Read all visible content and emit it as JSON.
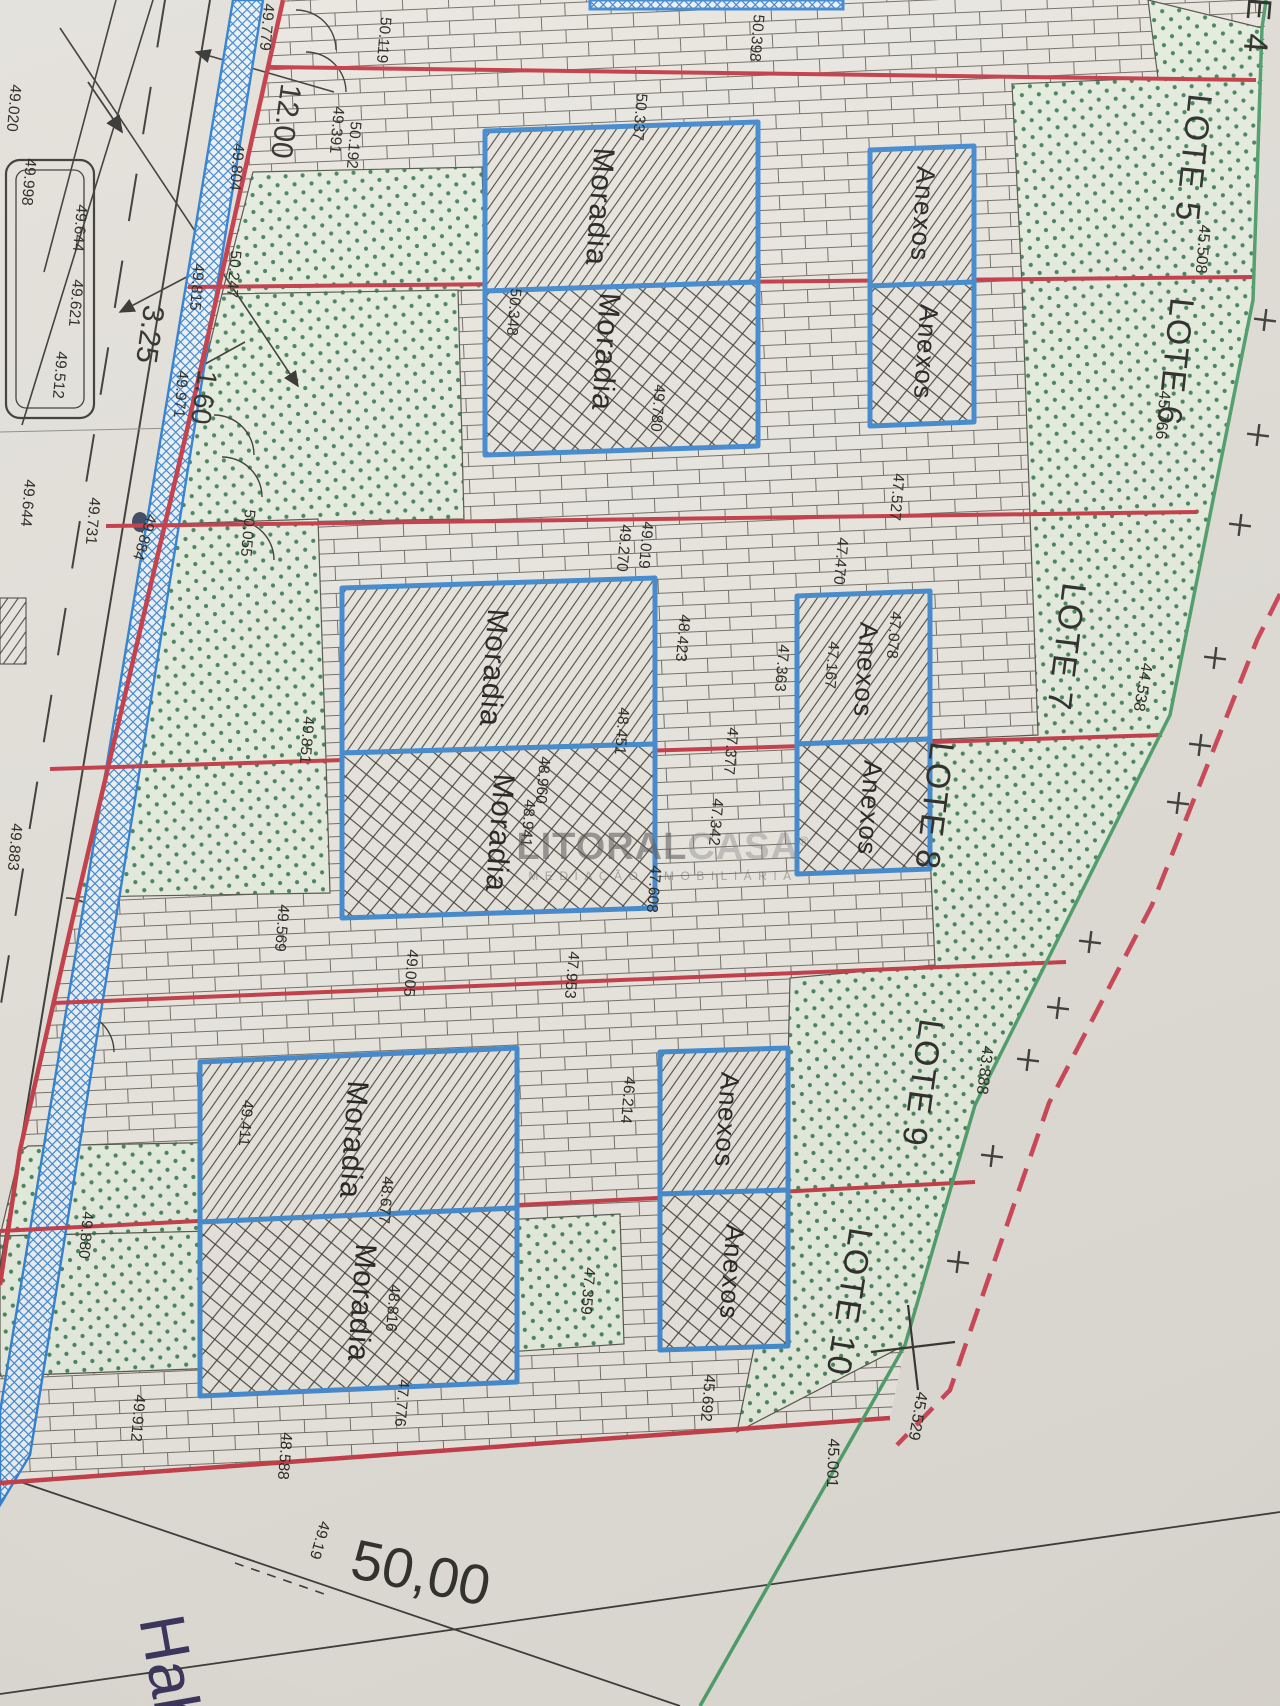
{
  "watermark": {
    "brand_bold": "LITORAL",
    "brand_light": "CASA",
    "registered": "®",
    "tagline": "MEDIAÇÃO IMOBILIÁRIA"
  },
  "plan": {
    "lot_labels": [
      {
        "t": "E 4",
        "x": 1255,
        "y": 26,
        "r": 95
      },
      {
        "t": "LOTE 5",
        "x": 1191,
        "y": 158,
        "r": 96
      },
      {
        "t": "LOTE 6",
        "x": 1173,
        "y": 362,
        "r": 96
      },
      {
        "t": "LOTE 7",
        "x": 1064,
        "y": 647,
        "r": 97
      },
      {
        "t": "LOTE 8",
        "x": 932,
        "y": 806,
        "r": 97
      },
      {
        "t": "LOTE 9",
        "x": 920,
        "y": 1083,
        "r": 98
      },
      {
        "t": "LOTE 10",
        "x": 847,
        "y": 1302,
        "r": 99
      }
    ],
    "elevations": [
      {
        "t": "49.020",
        "x": 13,
        "y": 108
      },
      {
        "t": "49.998",
        "x": 28,
        "y": 182
      },
      {
        "t": "49.644",
        "x": 79,
        "y": 228
      },
      {
        "t": "49.621",
        "x": 75,
        "y": 303
      },
      {
        "t": "49.512",
        "x": 59,
        "y": 375
      },
      {
        "t": "49.391",
        "x": 336,
        "y": 130
      },
      {
        "t": "49.644",
        "x": 27,
        "y": 503
      },
      {
        "t": "49.731",
        "x": 92,
        "y": 521
      },
      {
        "t": "49.884",
        "x": 144,
        "y": 537,
        "r": 108
      },
      {
        "t": "49.883",
        "x": 14,
        "y": 847
      },
      {
        "t": "49.779",
        "x": 266,
        "y": 27
      },
      {
        "t": "49.804",
        "x": 236,
        "y": 167
      },
      {
        "t": "49.815",
        "x": 196,
        "y": 287
      },
      {
        "t": "49.971",
        "x": 180,
        "y": 394
      },
      {
        "t": "50.247",
        "x": 233,
        "y": 274
      },
      {
        "t": "50.055",
        "x": 247,
        "y": 533
      },
      {
        "t": "49.851",
        "x": 306,
        "y": 740
      },
      {
        "t": "49.569",
        "x": 281,
        "y": 928
      },
      {
        "t": "49.880",
        "x": 85,
        "y": 1235
      },
      {
        "t": "49.912",
        "x": 137,
        "y": 1418
      },
      {
        "t": "50.119",
        "x": 383,
        "y": 40
      },
      {
        "t": "50.192",
        "x": 353,
        "y": 145
      },
      {
        "t": "50.398",
        "x": 756,
        "y": 38
      },
      {
        "t": "50.337",
        "x": 639,
        "y": 117
      },
      {
        "t": "50.348",
        "x": 513,
        "y": 312
      },
      {
        "t": "49.780",
        "x": 657,
        "y": 408
      },
      {
        "t": "49.019",
        "x": 645,
        "y": 545
      },
      {
        "t": "49.270",
        "x": 623,
        "y": 548
      },
      {
        "t": "47.527",
        "x": 896,
        "y": 497
      },
      {
        "t": "47.470",
        "x": 840,
        "y": 561
      },
      {
        "t": "47.078",
        "x": 893,
        "y": 635
      },
      {
        "t": "47.167",
        "x": 831,
        "y": 665
      },
      {
        "t": "48.423",
        "x": 682,
        "y": 638
      },
      {
        "t": "47.363",
        "x": 781,
        "y": 668
      },
      {
        "t": "48.451",
        "x": 621,
        "y": 731
      },
      {
        "t": "48.960",
        "x": 542,
        "y": 780
      },
      {
        "t": "48.941",
        "x": 527,
        "y": 823
      },
      {
        "t": "47.377",
        "x": 730,
        "y": 751
      },
      {
        "t": "47.342",
        "x": 715,
        "y": 822
      },
      {
        "t": "47.608",
        "x": 653,
        "y": 889
      },
      {
        "t": "49.005",
        "x": 410,
        "y": 973
      },
      {
        "t": "47.953",
        "x": 571,
        "y": 975
      },
      {
        "t": "46.214",
        "x": 627,
        "y": 1100
      },
      {
        "t": "49.411",
        "x": 245,
        "y": 1123
      },
      {
        "t": "48.677",
        "x": 385,
        "y": 1200
      },
      {
        "t": "48.816",
        "x": 392,
        "y": 1308
      },
      {
        "t": "47.359",
        "x": 587,
        "y": 1291
      },
      {
        "t": "45.692",
        "x": 707,
        "y": 1398
      },
      {
        "t": "47.776",
        "x": 401,
        "y": 1403
      },
      {
        "t": "48.588",
        "x": 284,
        "y": 1456
      },
      {
        "t": "49.19",
        "x": 319,
        "y": 1540,
        "r": 106
      },
      {
        "t": "45.508",
        "x": 1202,
        "y": 249,
        "s": 16
      },
      {
        "t": "45.766",
        "x": 1162,
        "y": 415,
        "s": 16
      },
      {
        "t": "44.538",
        "x": 1142,
        "y": 687,
        "r": 100,
        "s": 16
      },
      {
        "t": "43.888",
        "x": 984,
        "y": 1070,
        "r": 97,
        "s": 16
      },
      {
        "t": "45.529",
        "x": 917,
        "y": 1416,
        "r": 100,
        "s": 16
      },
      {
        "t": "45.001",
        "x": 832,
        "y": 1463,
        "r": 92,
        "s": 16
      }
    ],
    "dimension_labels": [
      {
        "t": "12.00",
        "x": 284,
        "y": 121,
        "r": 98,
        "s": 30
      },
      {
        "t": "3.25",
        "x": 148,
        "y": 334,
        "r": 98,
        "s": 30
      },
      {
        "t": "1.60",
        "x": 202,
        "y": 397,
        "r": 98,
        "s": 28
      },
      {
        "t": "50,00",
        "x": 420,
        "y": 1577,
        "r": 12,
        "s": 56
      }
    ],
    "margin_texts": [
      {
        "t": "Hab",
        "x": 166,
        "y": 1674,
        "r": 80,
        "s": 64,
        "serif": true,
        "fill": "#37315c"
      }
    ],
    "buildings": [
      {
        "id": "moradia-1",
        "x1": 485,
        "x2": 758,
        "ytl": 131,
        "ytr": 122,
        "ysl": 291,
        "ysr": 282,
        "ybl": 455,
        "ybr": 446,
        "top": "Moradia",
        "bot": "Moradia",
        "ltx": 598,
        "lty": 207,
        "lbx": 604,
        "lby": 352,
        "ls": 30
      },
      {
        "id": "anexos-1",
        "x1": 870,
        "x2": 974,
        "ytl": 150,
        "ytr": 146,
        "ysl": 286,
        "ysr": 282,
        "ybl": 426,
        "ybr": 422,
        "top": "Anexos",
        "bot": "Anexos",
        "ltx": 921,
        "lty": 214,
        "lbx": 924,
        "lby": 352,
        "ls": 26
      },
      {
        "id": "moradia-2",
        "x1": 342,
        "x2": 655,
        "ytl": 588,
        "ytr": 578,
        "ysl": 753,
        "ysr": 744,
        "ybl": 918,
        "ybr": 908,
        "top": "Moradia",
        "bot": "Moradia",
        "ltx": 492,
        "lty": 668,
        "lbx": 498,
        "lby": 833,
        "ls": 30
      },
      {
        "id": "anexos-2",
        "x1": 797,
        "x2": 930,
        "ytl": 596,
        "ytr": 591,
        "ysl": 744,
        "ysr": 739,
        "ybl": 874,
        "ybr": 869,
        "top": "Anexos",
        "bot": "Anexos",
        "ltx": 864,
        "lty": 670,
        "lbx": 868,
        "lby": 808,
        "ls": 26
      },
      {
        "id": "moradia-3",
        "x1": 200,
        "x2": 517,
        "ytl": 1062,
        "ytr": 1048,
        "ysl": 1222,
        "ysr": 1208,
        "ybl": 1396,
        "ybr": 1382,
        "top": "Moradia",
        "bot": "Moradia",
        "ltx": 352,
        "lty": 1140,
        "lbx": 360,
        "lby": 1303,
        "ls": 30
      },
      {
        "id": "anexos-3",
        "x1": 660,
        "x2": 788,
        "ytl": 1052,
        "ytr": 1048,
        "ysl": 1194,
        "ysr": 1190,
        "ybl": 1350,
        "ybr": 1346,
        "top": "Anexos",
        "bot": "Anexos",
        "ltx": 725,
        "lty": 1120,
        "lbx": 730,
        "lby": 1272,
        "ls": 26
      }
    ],
    "plus_marks": [
      [
        1265,
        320
      ],
      [
        1258,
        435
      ],
      [
        1240,
        525
      ],
      [
        1215,
        658
      ],
      [
        1200,
        745
      ],
      [
        1178,
        803
      ],
      [
        1090,
        942
      ],
      [
        1058,
        1008
      ],
      [
        1028,
        1060
      ],
      [
        992,
        1156
      ],
      [
        958,
        1262
      ]
    ]
  },
  "colors": {
    "paper": "#e3e0da",
    "lot_line_red": "#c43a46",
    "road_blue": "#2f7fd1",
    "boundary_green": "#4d9e6a",
    "boundary_red_dashed": "#cc4455",
    "lawn_dot_green": "#44835a",
    "building_blue": "#4189cf"
  }
}
